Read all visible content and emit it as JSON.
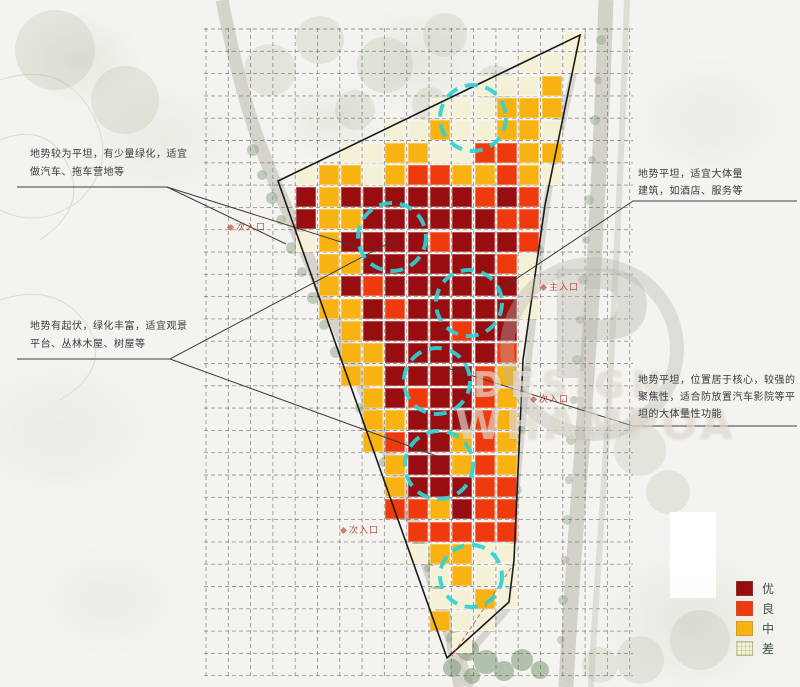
{
  "annotations": {
    "left_top": {
      "text_lines": [
        "地势较为平坦，有少量绿化，适宜",
        "做汽车、拖车营地等"
      ]
    },
    "left_mid": {
      "text_lines": [
        "地势有起伏，绿化丰富，适宜观景",
        "平台、丛林木屋、树屋等"
      ]
    },
    "right_top": {
      "text_lines": [
        "地势平坦，适宜大体量",
        "建筑，如酒店、服务等"
      ]
    },
    "right_mid": {
      "text_lines": [
        "地势平坦，位置居于核心，较强的",
        "聚焦性，适合防放置汽车影院等平",
        "坦的大体量性功能"
      ]
    }
  },
  "map_labels": [
    {
      "text": "次入口",
      "x": 228,
      "y": 220
    },
    {
      "text": "主入口",
      "x": 541,
      "y": 280
    },
    {
      "text": "次入口",
      "x": 531,
      "y": 392
    },
    {
      "text": "次入口",
      "x": 341,
      "y": 523
    }
  ],
  "legend": {
    "items": [
      {
        "label": "优",
        "color": "#970d10"
      },
      {
        "label": "良",
        "color": "#ee3a0d"
      },
      {
        "label": "中",
        "color": "#f8b211"
      },
      {
        "label": "差",
        "color": "#f4f2d6"
      }
    ]
  },
  "watermark": {
    "logo_letter": "P",
    "line1": "DESIGN",
    "line2": "WHAMPOA"
  },
  "chart_data": {
    "type": "heatmap",
    "title": "",
    "legend_labels": [
      "优",
      "良",
      "中",
      "差"
    ],
    "colors": {
      "r": "#970d10",
      "o": "#ee3a0d",
      "y": "#f8b211",
      "c": "#f4f1d6"
    },
    "origin": [
      206,
      30
    ],
    "grid": {
      "x0": 206,
      "y0": 29,
      "pitch": 22.3,
      "x_lines": 20,
      "y_lines": 30,
      "x_span": [
        204,
        633
      ],
      "y_span": [
        28,
        678
      ]
    },
    "matrix": [
      "................c..",
      "..............ccc..",
      "............cccy...",
      "..........cccyyy...",
      "........ccyccyyc...",
      "......ccyyccooyy...",
      "....cyycyooyyoyc...",
      "....ryrrrrrroro....",
      "....ryyrrrrrroo....",
      "....cyrrrrorrro....",
      ".....yyrrrrrroc....",
      ".....yrorrrrrrc....",
      ".....yyrorrrrrc....",
      "......yrrrrorr.....",
      "......yyrrrrro.....",
      "......yyrrrroy.....",
      ".......yrorroy.....",
      ".......yyrrroy.....",
      ".......yorryoy.....",
      "........yrryoy.....",
      "........yrrroo.....",
      "........ooyroo.....",
      ".........ooooo.....",
      ".........cyycc.....",
      "..........cycc.....",
      "..........ccyc.....",
      "..........ycc......",
      "...........c......."
    ],
    "site_polygon": "278,181 580,35 545,205 523,360 514,560 509,602 447,658",
    "edge_red": "511,568 452,656",
    "circle_color": "#2cd2d6",
    "circles": [
      [
        473,
        118,
        33
      ],
      [
        392,
        237,
        34
      ],
      [
        469,
        303,
        33
      ],
      [
        437,
        381,
        33
      ],
      [
        439,
        465,
        34
      ],
      [
        471,
        576,
        31
      ]
    ],
    "leaders": [
      "17,187 167,187 360,248",
      "167,187 286,244",
      "17,359 170,359 398,238",
      "170,359 442,458",
      "797,201 633,201 498,291",
      "797,426 633,426 444,367"
    ]
  }
}
